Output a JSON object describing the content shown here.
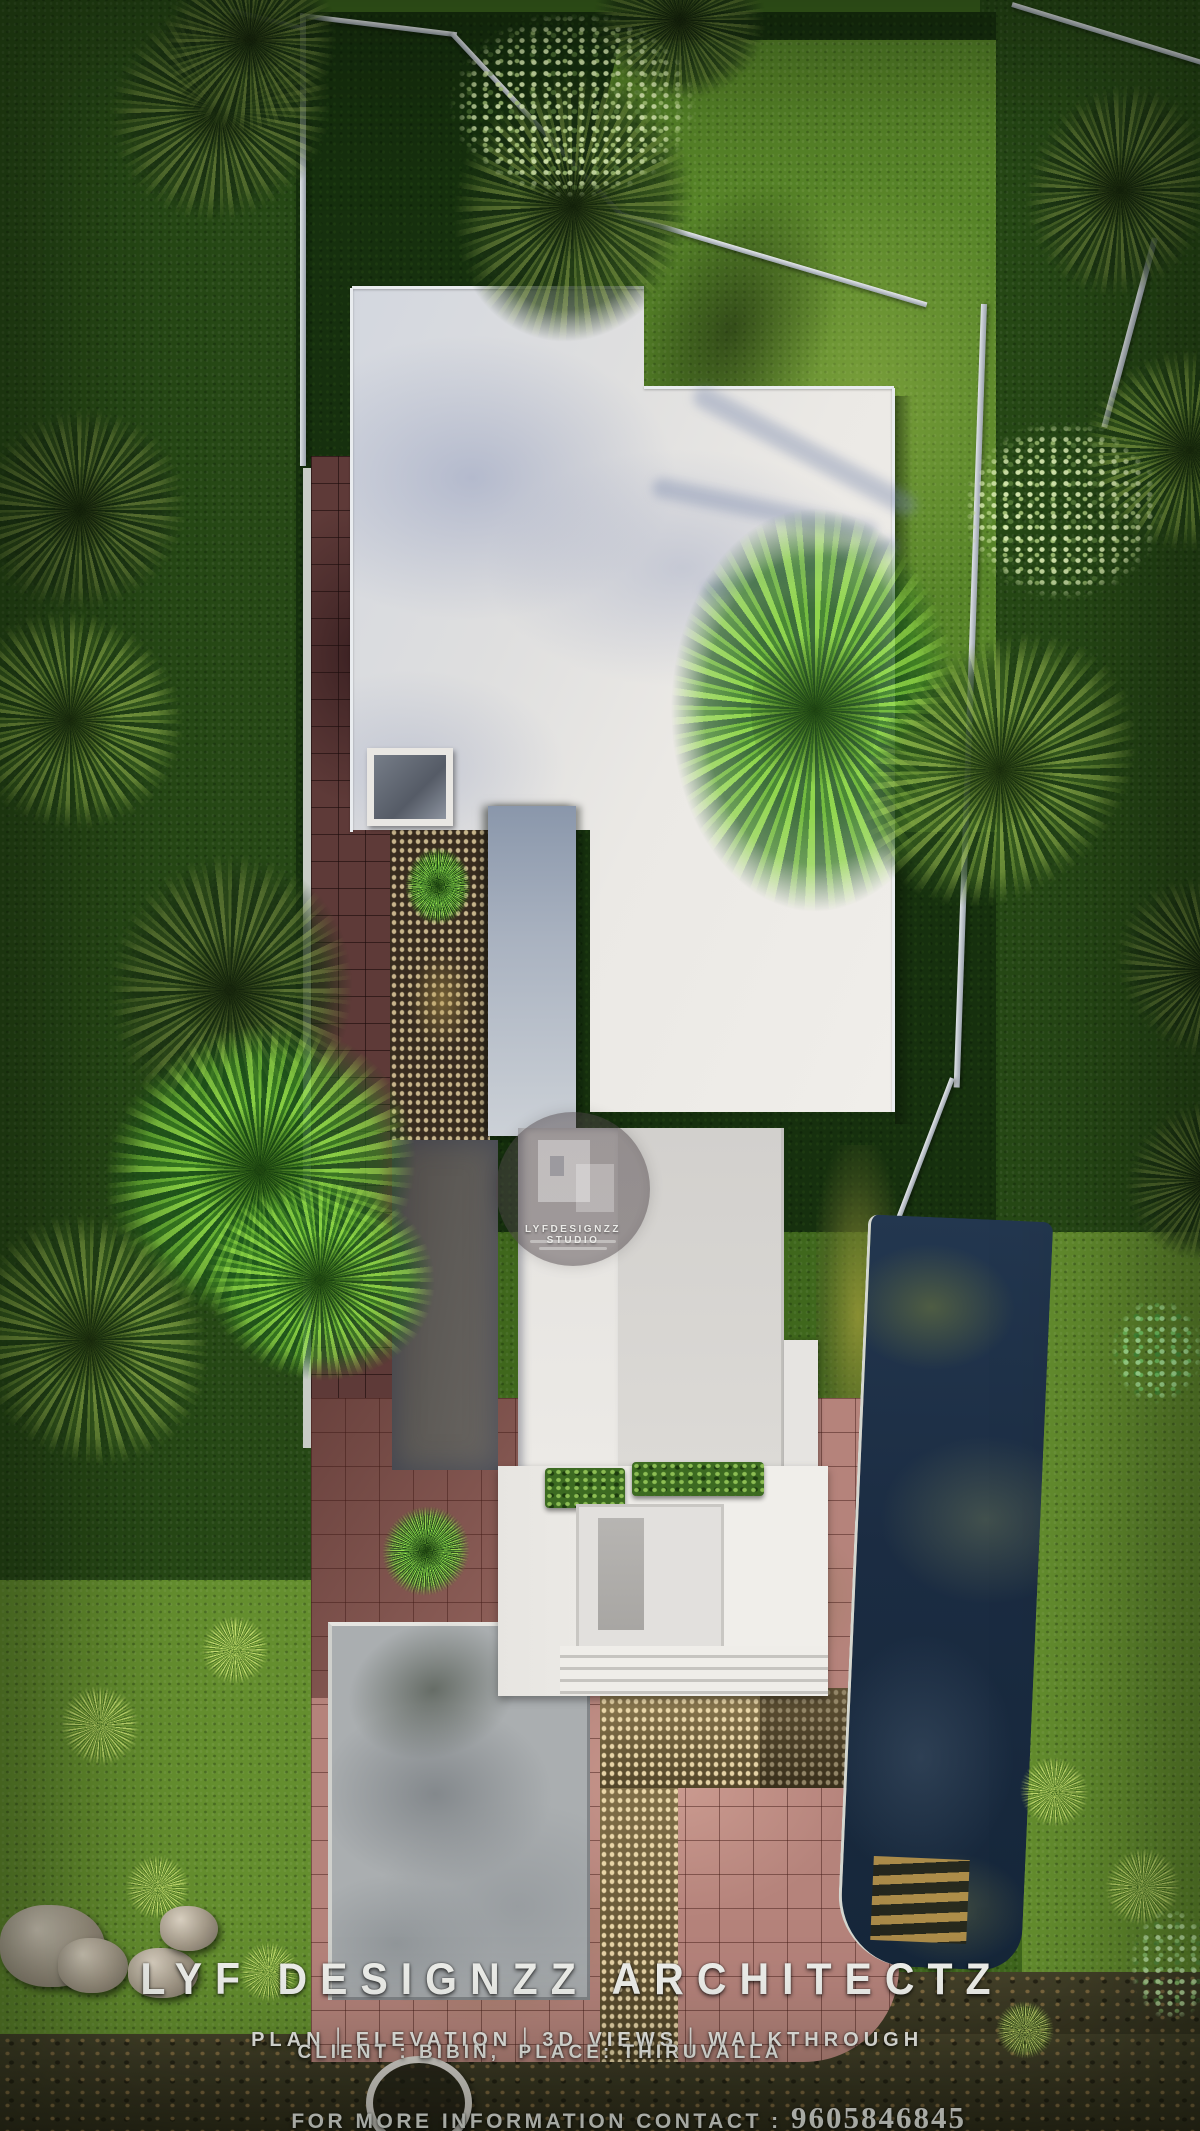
{
  "overlay": {
    "title": "LYF DESIGNZZ ARCHITECTZ",
    "services": [
      "PLAN",
      "ELEVATION",
      "3D VIEWS",
      "WALKTHROUGH"
    ],
    "services_separator": "|",
    "client_place": "CLIENT : BIBIN,  PLACE: THIRUVALLA",
    "contact_prefix": "FOR MORE INFORMATION CONTACT : ",
    "contact_number": "9605846845"
  },
  "watermark": {
    "studio": "LYFDESIGNZZ STUDIO"
  },
  "palette": {
    "lawn_dark": "#16300e",
    "lawn_sunlit": "#578428",
    "grass_moss": "#648e2e",
    "roof_white": "#ebe9e5",
    "roof_shadow_blue": "#bcc3d2",
    "paving_red_sunlit": "#b5837b",
    "paving_red_shaded": "#5e3a38",
    "concrete_pad": "#aaaeb0",
    "pool_water": "#1b2c42",
    "boundary_wall": "#ccd2d8",
    "overlay_text": "#eff0ec"
  }
}
